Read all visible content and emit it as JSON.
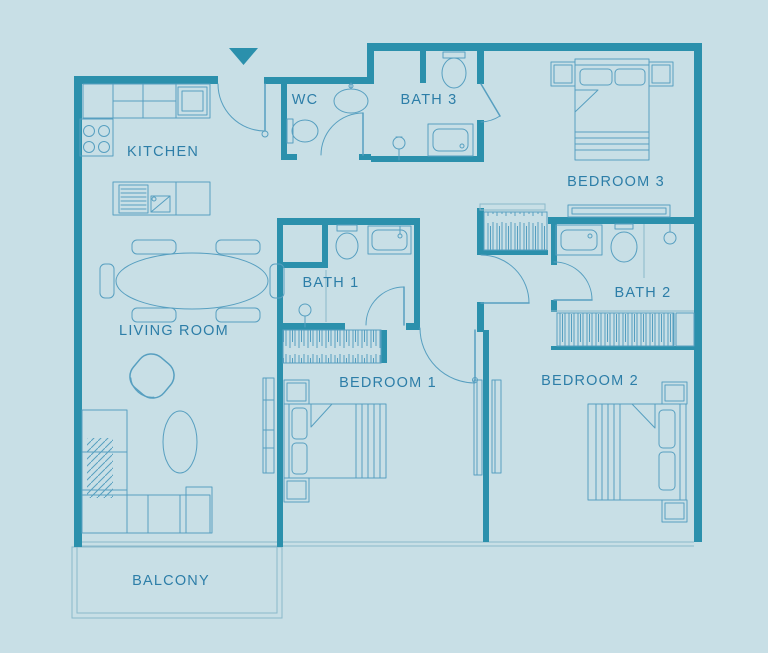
{
  "title": "3-bedroom apartment floor plan",
  "palette": {
    "background": "#c8dfe6",
    "wall": "#2b90ac",
    "line": "#579fc0",
    "lightline": "#8ab8cb",
    "label": "#2d7ea8"
  },
  "icons": {
    "entrance_marker": "triangle-down"
  },
  "rooms": {
    "kitchen": {
      "label": "KITCHEN"
    },
    "wc": {
      "label": "WC"
    },
    "bath3": {
      "label": "BATH 3"
    },
    "bedroom3": {
      "label": "BEDROOM 3"
    },
    "bath1": {
      "label": "BATH 1"
    },
    "bath2": {
      "label": "BATH 2"
    },
    "living_room": {
      "label": "LIVING ROOM"
    },
    "bedroom1": {
      "label": "BEDROOM 1"
    },
    "bedroom2": {
      "label": "BEDROOM 2"
    },
    "balcony": {
      "label": "BALCONY"
    }
  }
}
